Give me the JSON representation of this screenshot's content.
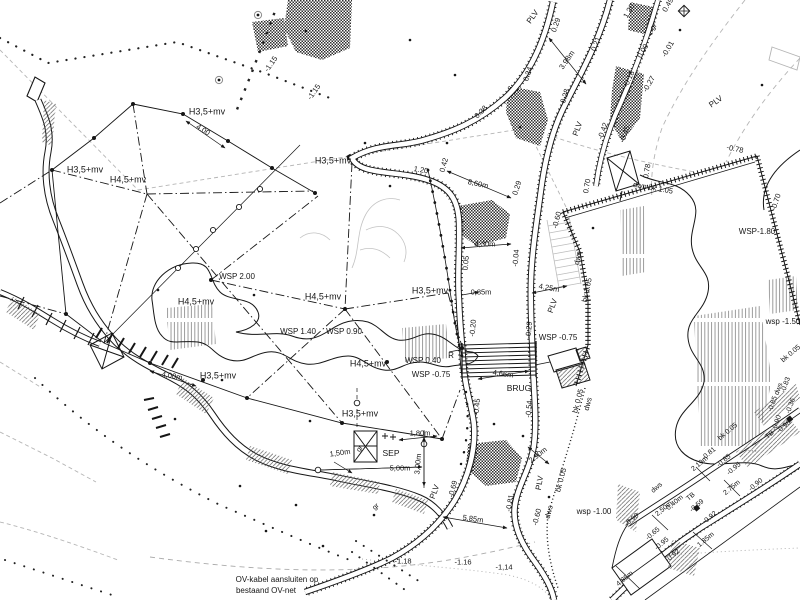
{
  "drawing": {
    "type": "civil-engineering site plan (Dutch water/landscape drawing)",
    "colors": {
      "ink": "#161616",
      "gray": "#b5b5b5",
      "paper": "#ffffff"
    },
    "note": {
      "line1": "OV-kabel aansluiten op",
      "line2": "bestaand OV-net"
    },
    "labels": [
      {
        "t": "H3,5+mv",
        "x": 207,
        "y": 112,
        "s": 9
      },
      {
        "t": "H3,5+mv",
        "x": 85,
        "y": 170,
        "s": 9
      },
      {
        "t": "H4,5+mv",
        "x": 128,
        "y": 180,
        "s": 9
      },
      {
        "t": "H3,5+mv",
        "x": 333,
        "y": 161,
        "s": 9
      },
      {
        "t": "H4,5+mv",
        "x": 196,
        "y": 302,
        "s": 9
      },
      {
        "t": "H4,5+mv",
        "x": 323,
        "y": 297,
        "s": 9
      },
      {
        "t": "H3,5+mv",
        "x": 218,
        "y": 376,
        "s": 9
      },
      {
        "t": "H3,5+mv",
        "x": 430,
        "y": 291,
        "s": 9
      },
      {
        "t": "H4,5+mv",
        "x": 368,
        "y": 364,
        "s": 9
      },
      {
        "t": "H3,5+mv",
        "x": 360,
        "y": 414,
        "s": 9
      },
      {
        "t": "WSP 2.00",
        "x": 237,
        "y": 277,
        "s": 8
      },
      {
        "t": "WSP 1.40",
        "x": 298,
        "y": 332,
        "s": 8
      },
      {
        "t": "WSP 0.90",
        "x": 344,
        "y": 332,
        "s": 8
      },
      {
        "t": "WSP 0.40",
        "x": 423,
        "y": 361,
        "s": 8
      },
      {
        "t": "WSP -0.75",
        "x": 431,
        "y": 375,
        "s": 8
      },
      {
        "t": "WSP -0.75",
        "x": 558,
        "y": 338,
        "s": 8
      },
      {
        "t": "WSP-1.80",
        "x": 757,
        "y": 232,
        "s": 8
      },
      {
        "t": "wsp -1.00",
        "x": 594,
        "y": 512,
        "s": 8
      },
      {
        "t": "wsp -1.50",
        "x": 783,
        "y": 322,
        "s": 8
      },
      {
        "t": "BRUG",
        "x": 519,
        "y": 388,
        "s": 8.5
      },
      {
        "t": "SEP",
        "x": 391,
        "y": 453,
        "s": 8.5
      },
      {
        "t": "R",
        "x": 451,
        "y": 356,
        "s": 8
      },
      {
        "t": "PLV",
        "x": 533,
        "y": 17,
        "r": -55,
        "s": 8
      },
      {
        "t": "PLV",
        "x": 578,
        "y": 129,
        "r": -70,
        "s": 8
      },
      {
        "t": "PLV",
        "x": 716,
        "y": 102,
        "r": -35,
        "s": 8
      },
      {
        "t": "PLV",
        "x": 553,
        "y": 306,
        "r": -70,
        "s": 8
      },
      {
        "t": "PLV",
        "x": 435,
        "y": 492,
        "r": -70,
        "s": 8
      },
      {
        "t": "PLV",
        "x": 540,
        "y": 483,
        "r": -80,
        "s": 8
      },
      {
        "t": "gr",
        "x": 654,
        "y": 27,
        "r": -50,
        "s": 7
      },
      {
        "t": "gr",
        "x": 360,
        "y": 449,
        "r": -55,
        "s": 7
      },
      {
        "t": "gr",
        "x": 376,
        "y": 507,
        "r": -40,
        "s": 7
      },
      {
        "t": "4.00",
        "x": 203,
        "y": 130,
        "r": 32,
        "s": 7.5
      },
      {
        "t": "1.20",
        "x": 421,
        "y": 170,
        "r": 10,
        "s": 7.5
      },
      {
        "t": "0.42",
        "x": 444,
        "y": 165,
        "r": -75,
        "s": 7.5
      },
      {
        "t": "8,60m",
        "x": 478,
        "y": 184,
        "r": 12,
        "s": 7.5
      },
      {
        "t": "0.29",
        "x": 517,
        "y": 188,
        "r": -72,
        "s": 7.5
      },
      {
        "t": "0.29",
        "x": 556,
        "y": 25,
        "r": -70,
        "s": 7.5
      },
      {
        "t": "0.34",
        "x": 528,
        "y": 74,
        "r": -72,
        "s": 7.5
      },
      {
        "t": "0.21",
        "x": 596,
        "y": 44,
        "r": -70,
        "s": 7.5
      },
      {
        "t": "3.98m",
        "x": 567,
        "y": 60,
        "r": -55,
        "s": 7.5
      },
      {
        "t": "0.28",
        "x": 565,
        "y": 96,
        "r": -72,
        "s": 7.5
      },
      {
        "t": "-0.18",
        "x": 629,
        "y": 79,
        "r": -65,
        "s": 7.5
      },
      {
        "t": "0.38",
        "x": 481,
        "y": 112,
        "r": -45,
        "s": 7.5
      },
      {
        "t": "-0.42",
        "x": 603,
        "y": 131,
        "r": -70,
        "s": 7.5
      },
      {
        "t": "-0.45",
        "x": 625,
        "y": 134,
        "r": -70,
        "s": 7.5
      },
      {
        "t": "1.20",
        "x": 629,
        "y": 11,
        "r": -60,
        "s": 7.5
      },
      {
        "t": "0.49",
        "x": 668,
        "y": 5,
        "r": -60,
        "s": 7.5
      },
      {
        "t": "0.00",
        "x": 643,
        "y": 51,
        "r": -60,
        "s": 7.5
      },
      {
        "t": "-0.01",
        "x": 668,
        "y": 49,
        "r": -60,
        "s": 7.5
      },
      {
        "t": "-0.27",
        "x": 649,
        "y": 84,
        "r": -60,
        "s": 7.5
      },
      {
        "t": "-0.78",
        "x": 735,
        "y": 149,
        "r": 12,
        "s": 7.5
      },
      {
        "t": "dwn bk 1.05",
        "x": 653,
        "y": 188,
        "r": 10,
        "s": 7.5
      },
      {
        "t": "0.78",
        "x": 647,
        "y": 171,
        "r": -80,
        "s": 7.5
      },
      {
        "t": "0.70",
        "x": 587,
        "y": 186,
        "r": -80,
        "s": 7.5
      },
      {
        "t": "dwn",
        "x": 578,
        "y": 258,
        "r": -78,
        "s": 7.5
      },
      {
        "t": "bk 1.05",
        "x": 587,
        "y": 290,
        "r": -78,
        "s": 7.5
      },
      {
        "t": "-0.70",
        "x": 776,
        "y": 202,
        "r": -72,
        "s": 7.5
      },
      {
        "t": "4.25m",
        "x": 549,
        "y": 288,
        "r": 10,
        "s": 7.5
      },
      {
        "t": "0.05",
        "x": 466,
        "y": 263,
        "r": -85,
        "s": 7.5
      },
      {
        "t": "-0.04",
        "x": 516,
        "y": 258,
        "r": -85,
        "s": 7.5
      },
      {
        "t": "4,30m",
        "x": 485,
        "y": 244,
        "s": 7.5
      },
      {
        "t": "-0.60",
        "x": 557,
        "y": 220,
        "r": -75,
        "s": 7.5
      },
      {
        "t": "0,85m",
        "x": 481,
        "y": 292,
        "s": 7.5
      },
      {
        "t": "-0.20",
        "x": 473,
        "y": 328,
        "r": -85,
        "s": 7.5
      },
      {
        "t": "-0.29",
        "x": 529,
        "y": 330,
        "r": -85,
        "s": 7.5
      },
      {
        "t": "4,66m",
        "x": 503,
        "y": 374,
        "r": 8,
        "s": 7.5
      },
      {
        "t": "-0.45",
        "x": 477,
        "y": 407,
        "r": -85,
        "s": 7.5
      },
      {
        "t": "-0.54",
        "x": 529,
        "y": 409,
        "r": -85,
        "s": 7.5
      },
      {
        "t": "bk 0.05",
        "x": 578,
        "y": 401,
        "r": -75,
        "s": 7.5
      },
      {
        "t": "dws",
        "x": 588,
        "y": 404,
        "r": -75,
        "s": 7.5
      },
      {
        "t": "2.90m",
        "x": 538,
        "y": 455,
        "r": -38,
        "s": 7.5
      },
      {
        "t": "bk 0.05",
        "x": 561,
        "y": 480,
        "r": -75,
        "s": 7.5
      },
      {
        "t": "-0.81",
        "x": 510,
        "y": 503,
        "r": -80,
        "s": 7.5
      },
      {
        "t": "-0.69",
        "x": 453,
        "y": 489,
        "r": -75,
        "s": 7.5
      },
      {
        "t": "-0.60",
        "x": 537,
        "y": 517,
        "r": -75,
        "s": 7.5
      },
      {
        "t": "dws",
        "x": 549,
        "y": 512,
        "r": -75,
        "s": 7.5
      },
      {
        "t": "5,85m",
        "x": 473,
        "y": 519,
        "r": 8,
        "s": 7.5
      },
      {
        "t": "-1.18",
        "x": 403,
        "y": 561,
        "s": 7.5
      },
      {
        "t": "-1.16",
        "x": 463,
        "y": 562,
        "s": 7.5
      },
      {
        "t": "-1,14",
        "x": 504,
        "y": 567,
        "s": 7.5
      },
      {
        "t": "1,80m",
        "x": 420,
        "y": 433,
        "s": 7.5
      },
      {
        "t": "1,50m",
        "x": 340,
        "y": 453,
        "r": -8,
        "s": 7.5
      },
      {
        "t": "5,00m",
        "x": 400,
        "y": 468,
        "s": 7.5
      },
      {
        "t": "3,00m",
        "x": 418,
        "y": 464,
        "r": -85,
        "s": 7.5
      },
      {
        "t": "4,00m",
        "x": 172,
        "y": 376,
        "r": 10,
        "s": 7.5
      },
      {
        "t": "-1.15",
        "x": 271,
        "y": 64,
        "r": -55,
        "s": 7.5
      },
      {
        "t": "-1.15",
        "x": 314,
        "y": 92,
        "r": -55,
        "s": 7.5
      },
      {
        "t": "OV-kabel aansluiten op",
        "x": 277,
        "y": 580,
        "s": 8
      },
      {
        "t": "bestaand OV-net",
        "x": 266,
        "y": 591,
        "s": 8
      },
      {
        "t": "bk 0.05",
        "x": 728,
        "y": 432,
        "r": -40,
        "s": 7
      },
      {
        "t": "TB",
        "x": 770,
        "y": 435,
        "r": -40,
        "s": 7
      },
      {
        "t": "-0.98",
        "x": 784,
        "y": 427,
        "r": -40,
        "s": 7
      },
      {
        "t": "-0.81",
        "x": 709,
        "y": 454,
        "r": -40,
        "s": 7
      },
      {
        "t": "2.19m",
        "x": 700,
        "y": 464,
        "r": -40,
        "s": 7
      },
      {
        "t": "-0.85",
        "x": 724,
        "y": 461,
        "r": -40,
        "s": 7
      },
      {
        "t": "-0.95",
        "x": 734,
        "y": 469,
        "r": -40,
        "s": 7
      },
      {
        "t": "2.75m",
        "x": 732,
        "y": 488,
        "r": -40,
        "s": 7
      },
      {
        "t": "-0.90",
        "x": 756,
        "y": 485,
        "r": -40,
        "s": 7
      },
      {
        "t": "dws",
        "x": 657,
        "y": 488,
        "r": -40,
        "s": 7
      },
      {
        "t": "TB",
        "x": 691,
        "y": 497,
        "r": -40,
        "s": 7
      },
      {
        "t": "0,40m",
        "x": 675,
        "y": 503,
        "r": -40,
        "s": 7
      },
      {
        "t": "-0.59",
        "x": 697,
        "y": 506,
        "r": -40,
        "s": 7
      },
      {
        "t": "2,50m",
        "x": 664,
        "y": 509,
        "r": -40,
        "s": 7
      },
      {
        "t": "-0.90",
        "x": 632,
        "y": 520,
        "r": -40,
        "s": 7
      },
      {
        "t": "-0.92",
        "x": 710,
        "y": 518,
        "r": -40,
        "s": 7
      },
      {
        "t": "-0.65",
        "x": 653,
        "y": 534,
        "r": -40,
        "s": 7
      },
      {
        "t": "-0.95",
        "x": 662,
        "y": 544,
        "r": -40,
        "s": 7
      },
      {
        "t": "1.85m",
        "x": 706,
        "y": 540,
        "r": -40,
        "s": 7
      },
      {
        "t": "-0.92",
        "x": 673,
        "y": 556,
        "r": -40,
        "s": 7
      },
      {
        "t": "4.85m",
        "x": 625,
        "y": 579,
        "r": -40,
        "s": 7
      },
      {
        "t": "bk 0.05",
        "x": 791,
        "y": 354,
        "r": -40,
        "s": 7
      },
      {
        "t": "-0.83",
        "x": 786,
        "y": 385,
        "r": -70,
        "s": 7
      },
      {
        "t": "dws",
        "x": 779,
        "y": 389,
        "r": -70,
        "s": 7
      },
      {
        "t": "-0.85",
        "x": 773,
        "y": 404,
        "r": -70,
        "s": 7
      },
      {
        "t": "-0.36",
        "x": 791,
        "y": 406,
        "r": -70,
        "s": 7
      },
      {
        "t": "-0.90",
        "x": 777,
        "y": 423,
        "r": -70,
        "s": 7
      }
    ]
  }
}
